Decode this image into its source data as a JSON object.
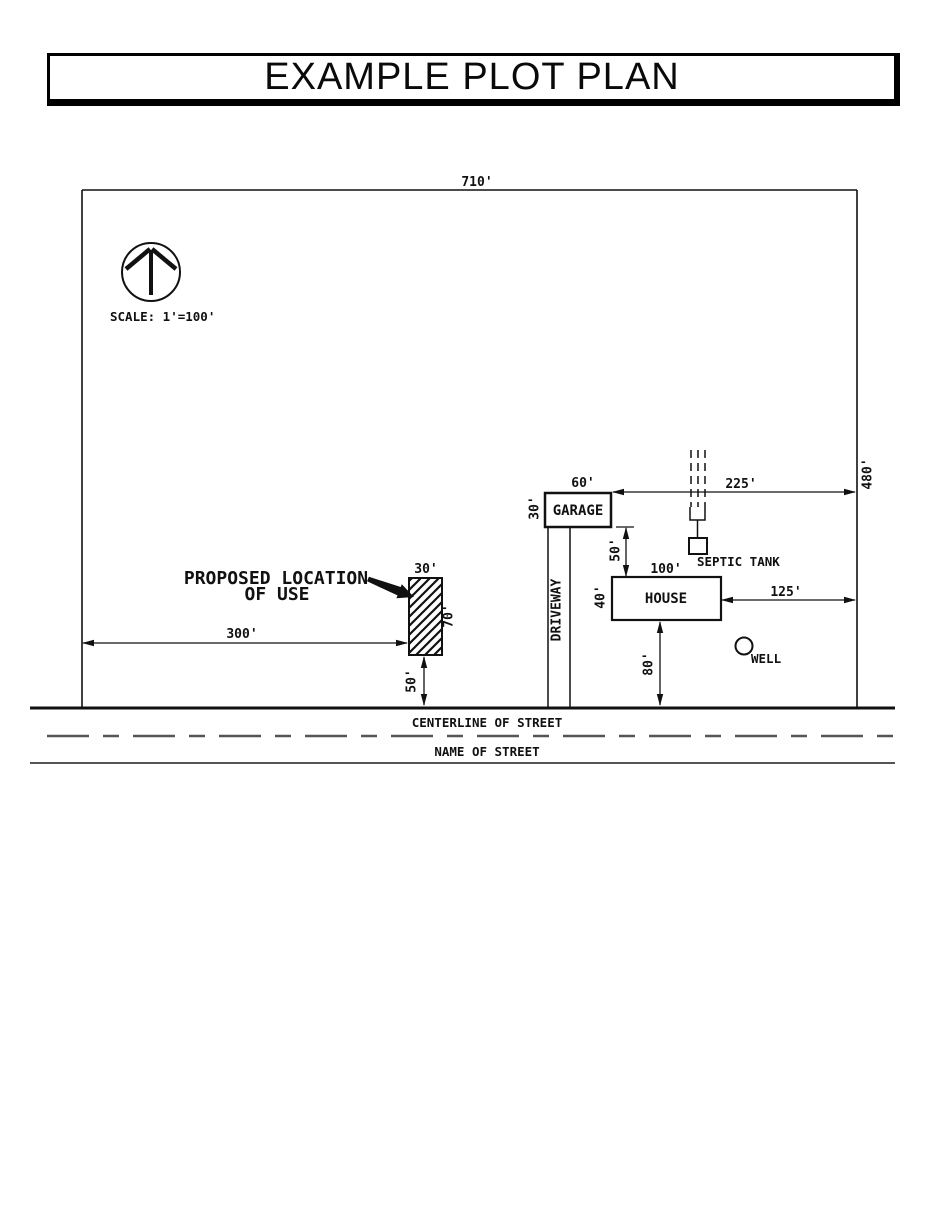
{
  "title": "EXAMPLE PLOT PLAN",
  "plan": {
    "scale_label": "SCALE: 1'=100'",
    "lot": {
      "width_top": "710'",
      "depth_right": "480'"
    },
    "garage": {
      "label": "GARAGE",
      "width": "60'",
      "depth": "30'"
    },
    "house": {
      "label": "HOUSE",
      "width": "100'",
      "depth": "40'"
    },
    "septic": {
      "label": "SEPTIC TANK"
    },
    "well": {
      "label": "WELL"
    },
    "driveway": {
      "label": "DRIVEWAY"
    },
    "proposed_use": {
      "label_line1": "PROPOSED LOCATION",
      "label_line2": "OF USE",
      "width": "30'",
      "depth": "70'"
    },
    "setbacks": {
      "garage_to_rear": "225'",
      "garage_to_house": "50'",
      "house_to_side": "125'",
      "house_to_street": "80'",
      "use_to_side": "300'",
      "use_to_street": "50'"
    },
    "street": {
      "centerline_label": "CENTERLINE OF STREET",
      "name_label": "NAME OF STREET"
    }
  },
  "colors": {
    "ink": "#111111",
    "street_gray": "#555555"
  }
}
